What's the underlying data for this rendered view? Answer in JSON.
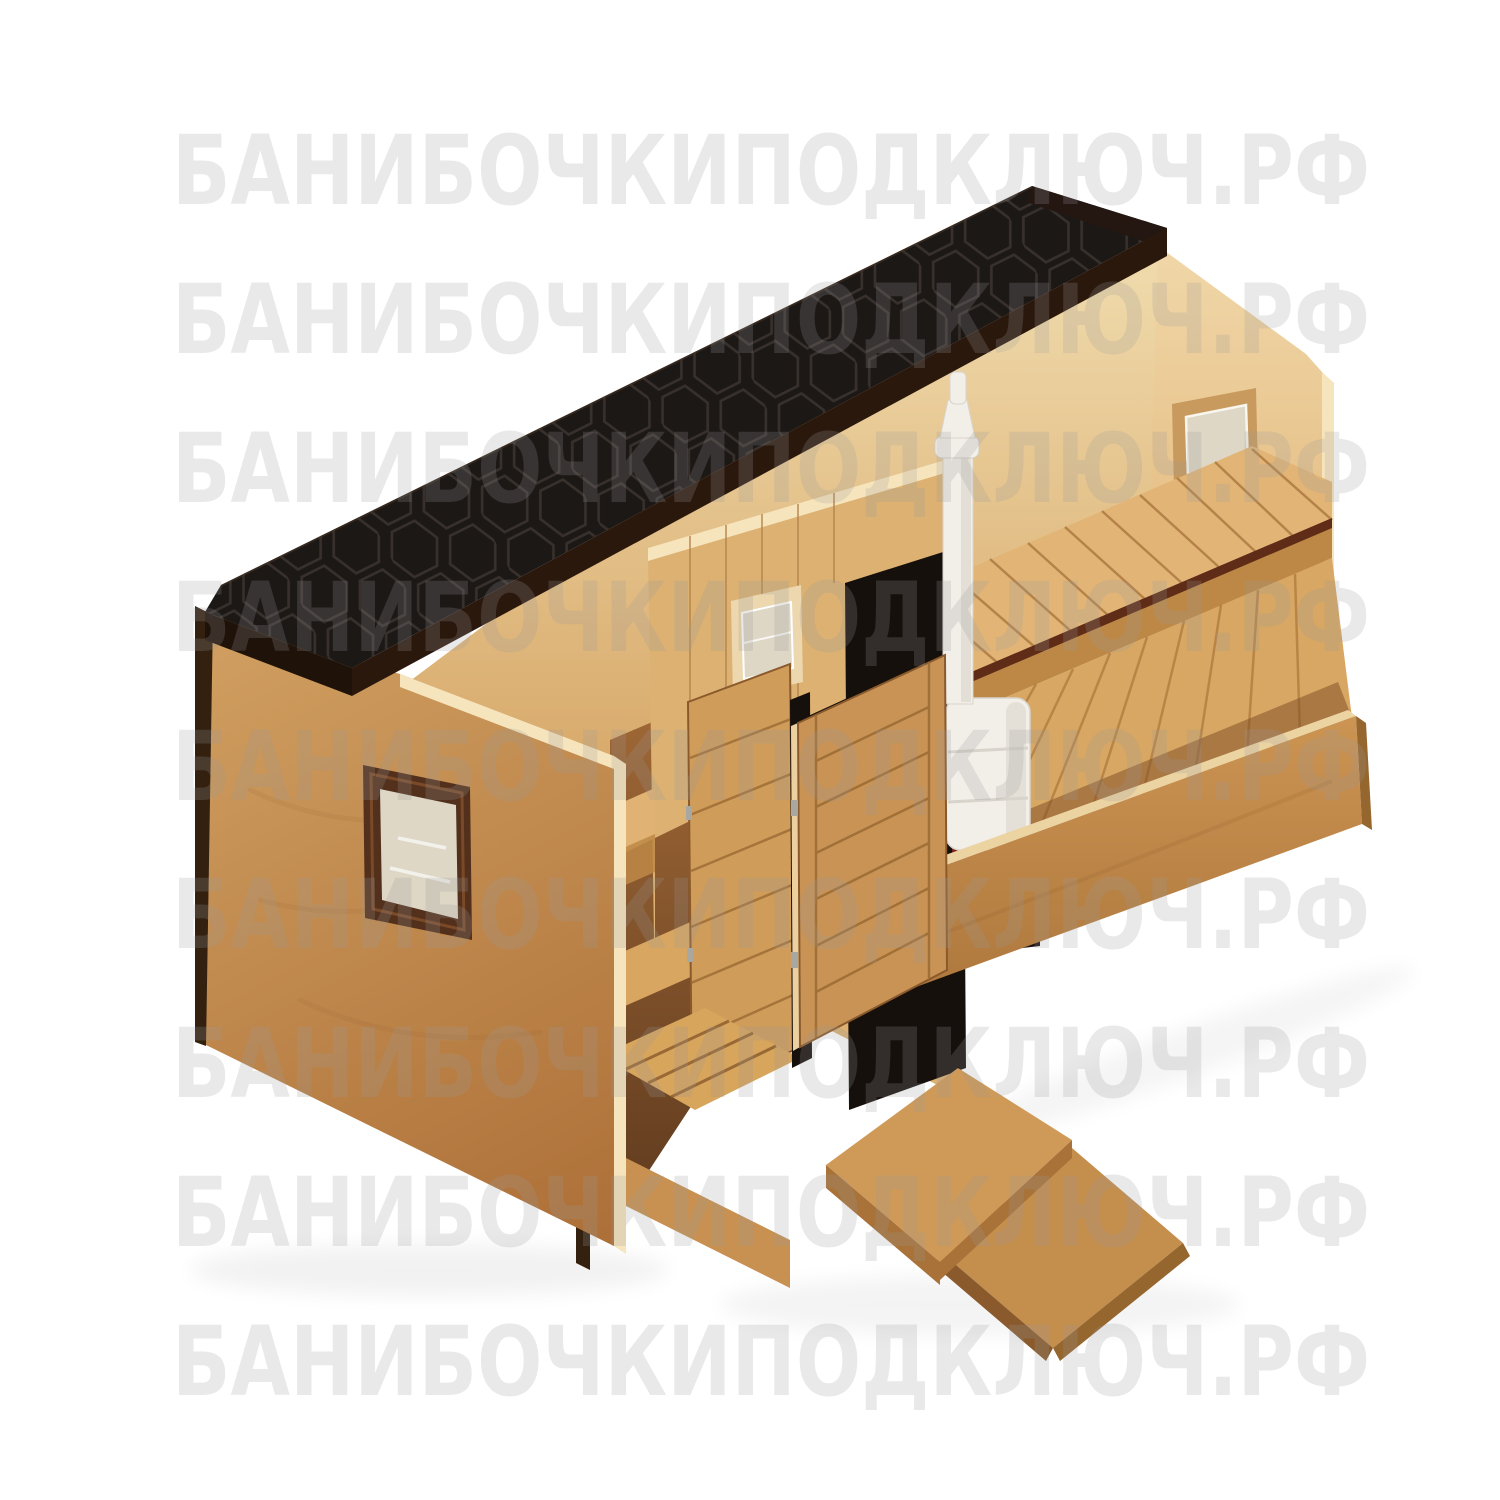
{
  "watermark": {
    "text": "БАНИБОЧКИПОДКЛЮЧ.РФ",
    "row_count": 9,
    "color": "#9b9b9b"
  },
  "scene": {
    "subject": "isometric cutaway 3D render of a rectangular cabin sauna (banya) with black shingle roof, two rooms, wood-fired stove with chimney and an open entrance door with ramp",
    "colors": {
      "background": "#ffffff",
      "roof_top": "#1c1816",
      "roof_hex_line": "#3a332e",
      "roof_fascia": "#2b180d",
      "roof_fascia_left": "#1f1209",
      "roof_edge_dark": "#241712",
      "ridge_highlight": "#4a3626",
      "plywood_top": "#f2dfb2",
      "plywood_bottom": "#d29d5a",
      "end_wall_top": "#f0d7a8",
      "end_wall_bottom": "#ddaa68",
      "cream_edge": "#f6e4bc",
      "left_wall_light": "#cf9d5f",
      "left_wall_dark": "#ad7038",
      "low_wall_light": "#cd9553",
      "low_wall_dark": "#a9733a",
      "low_wall_top_edge": "#ecd3a2",
      "plank_wall": "#dcb172",
      "plank_line": "#b4834a",
      "pale_frame": "#ecd7ae",
      "window_frame_brown": "#53301b",
      "window_frame_bevel": "#7a4a28",
      "glass": "#ded7c6",
      "glass_highlight": "#ffffff",
      "recess_side": "#c89a5e",
      "recess_sill": "#b9854b",
      "bench_top": "#e2b577",
      "bench_face": "#bd8845",
      "bench_gap": "#5e2c17",
      "bench_slat_line": "#a5733a",
      "floor": "#d8a763",
      "floor_line": "#a06a32",
      "floor_shadow": "#7c4a24",
      "interior_shadow_top": "#a06836",
      "interior_shadow_bottom": "#5e3a1e",
      "washroom_bench": "#e0b274",
      "wash_step": "#d8a660",
      "trapik": "#d8a55c",
      "trapik_line": "#8a5a2c",
      "skirt": "#c89152",
      "trim_dark": "#33200f",
      "door_wood": "#c99355",
      "inner_door_wood": "#cf9c5a",
      "door_line": "#9a6a33",
      "door_edge": "#ecd0a0",
      "door_frame_black": "#16100c",
      "hinge": "#a8a8a0",
      "stove_body": "#f2efe9",
      "stove_shade": "#d8d3cb",
      "stove_outline": "#d9d4cc",
      "stove_base_red": "#7c241c",
      "stove_base_black": "#1d1412",
      "ramp": "#c48e4d",
      "ramp_edge": "#96662f",
      "platform": "#cf9a58",
      "platform_face": "#a87238",
      "platform_side": "#8a5a2c",
      "shadow": "#000000"
    }
  }
}
